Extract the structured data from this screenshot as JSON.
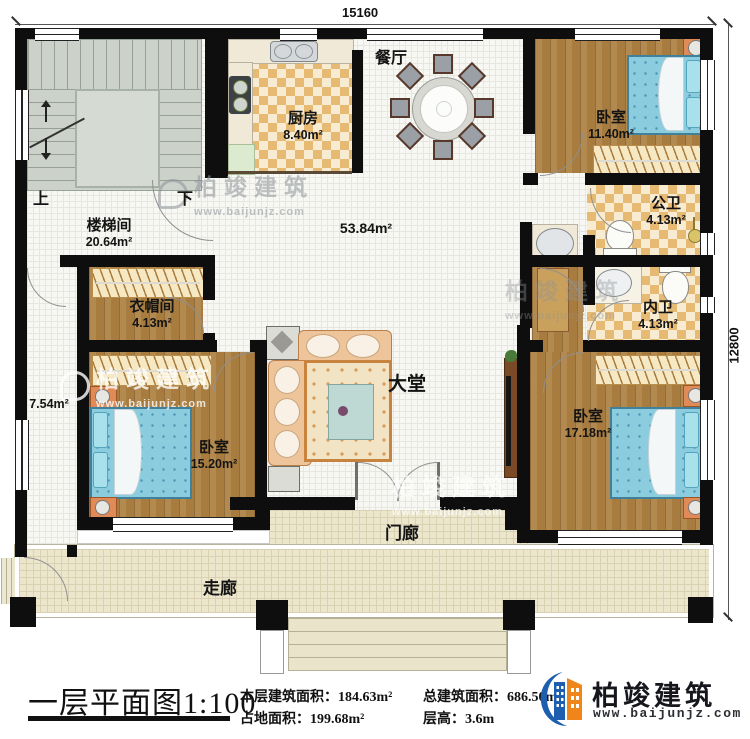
{
  "dimensions": {
    "top": "15160",
    "right": "12800"
  },
  "stairs": {
    "up": "上",
    "down": "下"
  },
  "rooms": {
    "staircase": {
      "name": "楼梯间",
      "area": "20.64m²"
    },
    "kitchen": {
      "name": "厨房",
      "area": "8.40m²"
    },
    "dining": {
      "name": "餐厅"
    },
    "bedroom_top": {
      "name": "卧室",
      "area": "11.40m²"
    },
    "public_bath": {
      "name": "公卫",
      "area": "4.13m²"
    },
    "inner_bath": {
      "name": "内卫",
      "area": "4.13m²"
    },
    "cloakroom": {
      "name": "衣帽间",
      "area": "4.13m²"
    },
    "bedroom_left": {
      "name": "卧室",
      "area": "15.20m²"
    },
    "bedroom_right": {
      "name": "卧室",
      "area": "17.18m²"
    },
    "hall": {
      "name": "大堂"
    },
    "porch": {
      "name": "门廊"
    },
    "corridor": {
      "name": "走廊"
    }
  },
  "open_area": "53.84m²",
  "side_area": "7.54m²",
  "title_block": {
    "title": "一层平面图1:100",
    "stats": [
      {
        "label": "本层建筑面积：",
        "value": "184.63m²"
      },
      {
        "label": "占地面积：",
        "value": "199.68m²"
      },
      {
        "label": "总建筑面积：",
        "value": "686.50m²"
      },
      {
        "label": "层高：",
        "value": "3.6m"
      }
    ]
  },
  "brand": {
    "name": "柏竣建筑",
    "url": "www.baijunjz.com"
  }
}
